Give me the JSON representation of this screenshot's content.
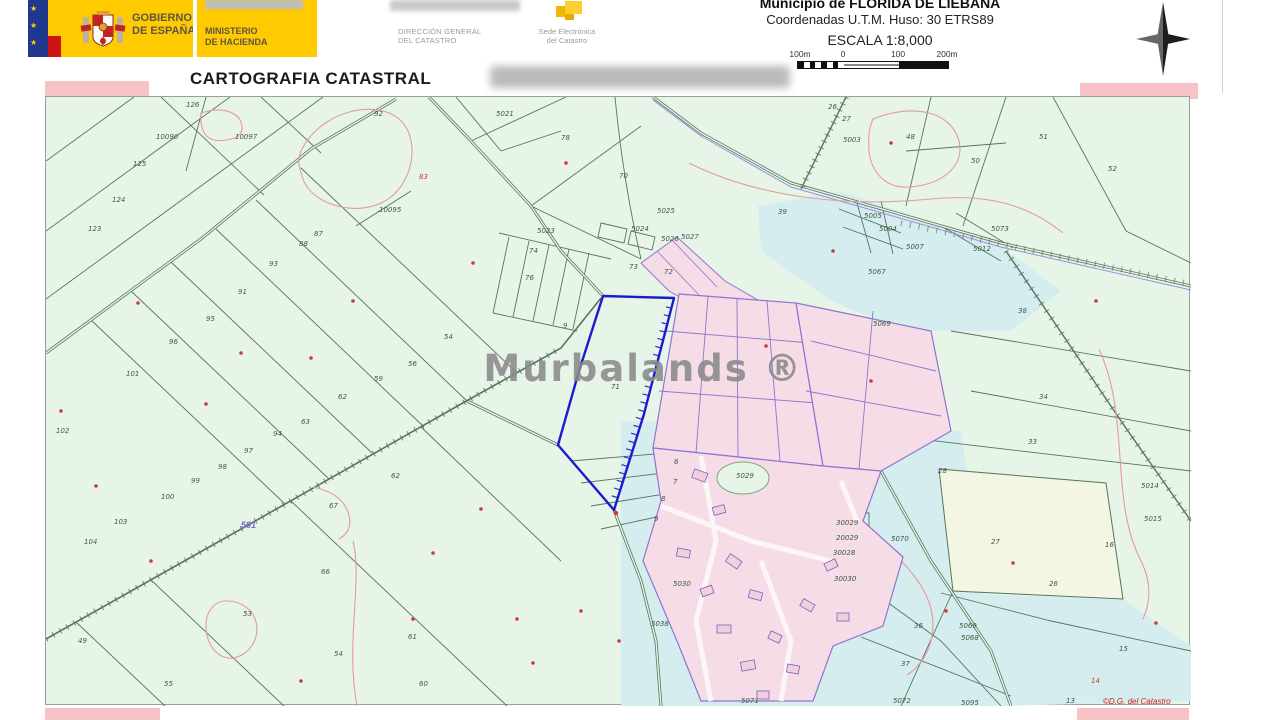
{
  "header": {
    "gobierno": {
      "line1": "GOBIERNO",
      "line2": "DE ESPAÑA"
    },
    "ministerio": {
      "line1": "MINISTERIO",
      "line2": "DE HACIENDA"
    },
    "direccion": {
      "line1": "DIRECCIÓN GENERAL",
      "line2": "DEL CATASTRO"
    },
    "sede": {
      "line1": "Sede Electrónica",
      "line2": "del Catastro"
    },
    "municipio": "Municipio de FLORIDA DE LIEBANA",
    "coordenadas": "Coordenadas U.T.M. Huso: 30 ETRS89",
    "escala": "ESCALA 1:8,000",
    "scalebar": {
      "l0": "100m",
      "l1": "0",
      "l2": "100",
      "l3": "200m"
    },
    "title": "CARTOGRAFIA CATASTRAL"
  },
  "map": {
    "watermark": "Murbalands ®",
    "credit": "©D.G. del Catastro",
    "road_label": "501",
    "highlighted_parcel": "71",
    "colors": {
      "background": "#e7f5e8",
      "cyan_zone": "#d6edef",
      "cream_zone": "#f3f6e2",
      "parcel_line": "#55755e",
      "contour_red": "#e49a9a",
      "village_fill": "#f5dce6",
      "village_stroke": "#8f74d2",
      "highlight_blue": "#1a1ad0"
    },
    "labels": [
      {
        "t": "126",
        "x": 185,
        "y": 106,
        "c": "g"
      },
      {
        "t": "10090",
        "x": 155,
        "y": 138,
        "c": "g"
      },
      {
        "t": "10097",
        "x": 234,
        "y": 138,
        "c": "g"
      },
      {
        "t": "125",
        "x": 132,
        "y": 165,
        "c": "g"
      },
      {
        "t": "124",
        "x": 111,
        "y": 201,
        "c": "g"
      },
      {
        "t": "123",
        "x": 87,
        "y": 230,
        "c": "g"
      },
      {
        "t": "92",
        "x": 373,
        "y": 115,
        "c": "g"
      },
      {
        "t": "88",
        "x": 298,
        "y": 245,
        "c": "g"
      },
      {
        "t": "87",
        "x": 313,
        "y": 235,
        "c": "g"
      },
      {
        "t": "93",
        "x": 268,
        "y": 265,
        "c": "g"
      },
      {
        "t": "91",
        "x": 237,
        "y": 293,
        "c": "g"
      },
      {
        "t": "95",
        "x": 205,
        "y": 320,
        "c": "g"
      },
      {
        "t": "96",
        "x": 168,
        "y": 343,
        "c": "g"
      },
      {
        "t": "101",
        "x": 125,
        "y": 375,
        "c": "g"
      },
      {
        "t": "102",
        "x": 55,
        "y": 432,
        "c": "g"
      },
      {
        "t": "10095",
        "x": 378,
        "y": 211,
        "c": "g"
      },
      {
        "t": "83",
        "x": 418,
        "y": 178,
        "c": "r"
      },
      {
        "t": "100",
        "x": 160,
        "y": 498,
        "c": "g"
      },
      {
        "t": "103",
        "x": 113,
        "y": 523,
        "c": "g"
      },
      {
        "t": "104",
        "x": 83,
        "y": 543,
        "c": "g"
      },
      {
        "t": "99",
        "x": 190,
        "y": 482,
        "c": "g"
      },
      {
        "t": "98",
        "x": 217,
        "y": 468,
        "c": "g"
      },
      {
        "t": "97",
        "x": 243,
        "y": 452,
        "c": "g"
      },
      {
        "t": "94",
        "x": 272,
        "y": 435,
        "c": "g"
      },
      {
        "t": "63",
        "x": 300,
        "y": 423,
        "c": "g"
      },
      {
        "t": "67",
        "x": 328,
        "y": 507,
        "c": "g"
      },
      {
        "t": "62",
        "x": 390,
        "y": 477,
        "c": "g"
      },
      {
        "t": "66",
        "x": 320,
        "y": 573,
        "c": "g"
      },
      {
        "t": "53",
        "x": 242,
        "y": 615,
        "c": "g"
      },
      {
        "t": "49",
        "x": 77,
        "y": 642,
        "c": "g"
      },
      {
        "t": "55",
        "x": 163,
        "y": 685,
        "c": "g"
      },
      {
        "t": "54",
        "x": 333,
        "y": 655,
        "c": "g"
      },
      {
        "t": "61",
        "x": 407,
        "y": 638,
        "c": "g"
      },
      {
        "t": "60",
        "x": 418,
        "y": 685,
        "c": "g"
      },
      {
        "t": "54",
        "x": 443,
        "y": 338,
        "c": "g"
      },
      {
        "t": "56",
        "x": 407,
        "y": 365,
        "c": "g"
      },
      {
        "t": "59",
        "x": 373,
        "y": 380,
        "c": "g"
      },
      {
        "t": "62",
        "x": 337,
        "y": 398,
        "c": "g"
      },
      {
        "t": "70",
        "x": 618,
        "y": 177,
        "c": "g"
      },
      {
        "t": "5021",
        "x": 495,
        "y": 115,
        "c": "g"
      },
      {
        "t": "78",
        "x": 560,
        "y": 139,
        "c": "g"
      },
      {
        "t": "76",
        "x": 524,
        "y": 279,
        "c": "g"
      },
      {
        "t": "74",
        "x": 528,
        "y": 252,
        "c": "g"
      },
      {
        "t": "73",
        "x": 628,
        "y": 268,
        "c": "g"
      },
      {
        "t": "72",
        "x": 663,
        "y": 273,
        "c": "g"
      },
      {
        "t": "5023",
        "x": 536,
        "y": 232,
        "c": "g"
      },
      {
        "t": "5024",
        "x": 630,
        "y": 230,
        "c": "g"
      },
      {
        "t": "5025",
        "x": 656,
        "y": 212,
        "c": "g"
      },
      {
        "t": "5026",
        "x": 660,
        "y": 240,
        "c": "g"
      },
      {
        "t": "5027",
        "x": 680,
        "y": 238,
        "c": "g"
      },
      {
        "t": "9",
        "x": 562,
        "y": 327,
        "c": "g"
      },
      {
        "t": "71",
        "x": 610,
        "y": 388,
        "c": "g"
      },
      {
        "t": "26",
        "x": 827,
        "y": 108,
        "c": "g"
      },
      {
        "t": "27",
        "x": 841,
        "y": 120,
        "c": "g"
      },
      {
        "t": "5003",
        "x": 842,
        "y": 141,
        "c": "g"
      },
      {
        "t": "48",
        "x": 905,
        "y": 138,
        "c": "g"
      },
      {
        "t": "50",
        "x": 970,
        "y": 162,
        "c": "g"
      },
      {
        "t": "51",
        "x": 1038,
        "y": 138,
        "c": "g"
      },
      {
        "t": "52",
        "x": 1107,
        "y": 170,
        "c": "g"
      },
      {
        "t": "39",
        "x": 777,
        "y": 213,
        "c": "g"
      },
      {
        "t": "5004",
        "x": 878,
        "y": 230,
        "c": "g"
      },
      {
        "t": "5005",
        "x": 863,
        "y": 217,
        "c": "g"
      },
      {
        "t": "5007",
        "x": 905,
        "y": 248,
        "c": "g"
      },
      {
        "t": "5067",
        "x": 867,
        "y": 273,
        "c": "g"
      },
      {
        "t": "5012",
        "x": 972,
        "y": 250,
        "c": "g"
      },
      {
        "t": "5073",
        "x": 990,
        "y": 230,
        "c": "g"
      },
      {
        "t": "38",
        "x": 1017,
        "y": 312,
        "c": "g"
      },
      {
        "t": "5069",
        "x": 872,
        "y": 325,
        "c": "g"
      },
      {
        "t": "5029",
        "x": 735,
        "y": 477,
        "c": "g"
      },
      {
        "t": "28",
        "x": 937,
        "y": 472,
        "c": "g"
      },
      {
        "t": "34",
        "x": 1038,
        "y": 398,
        "c": "g"
      },
      {
        "t": "33",
        "x": 1027,
        "y": 443,
        "c": "g"
      },
      {
        "t": "27",
        "x": 990,
        "y": 543,
        "c": "g"
      },
      {
        "t": "26",
        "x": 1048,
        "y": 585,
        "c": "g"
      },
      {
        "t": "5070",
        "x": 890,
        "y": 540,
        "c": "g"
      },
      {
        "t": "30029",
        "x": 835,
        "y": 524,
        "c": "g"
      },
      {
        "t": "20029",
        "x": 835,
        "y": 539,
        "c": "g"
      },
      {
        "t": "30028",
        "x": 832,
        "y": 554,
        "c": "g"
      },
      {
        "t": "30030",
        "x": 833,
        "y": 580,
        "c": "g"
      },
      {
        "t": "5030",
        "x": 672,
        "y": 585,
        "c": "g"
      },
      {
        "t": "5038",
        "x": 650,
        "y": 625,
        "c": "g"
      },
      {
        "t": "36",
        "x": 913,
        "y": 627,
        "c": "g"
      },
      {
        "t": "37",
        "x": 900,
        "y": 665,
        "c": "g"
      },
      {
        "t": "5069",
        "x": 958,
        "y": 627,
        "c": "g"
      },
      {
        "t": "5068",
        "x": 960,
        "y": 639,
        "c": "g"
      },
      {
        "t": "5071",
        "x": 740,
        "y": 702,
        "c": "g"
      },
      {
        "t": "5072",
        "x": 892,
        "y": 702,
        "c": "g"
      },
      {
        "t": "5095",
        "x": 960,
        "y": 704,
        "c": "g"
      },
      {
        "t": "5014",
        "x": 1140,
        "y": 487,
        "c": "g"
      },
      {
        "t": "5015",
        "x": 1143,
        "y": 520,
        "c": "g"
      },
      {
        "t": "16",
        "x": 1104,
        "y": 546,
        "c": "g"
      },
      {
        "t": "15",
        "x": 1118,
        "y": 650,
        "c": "g"
      },
      {
        "t": "13",
        "x": 1065,
        "y": 702,
        "c": "g"
      },
      {
        "t": "14",
        "x": 1090,
        "y": 682,
        "c": "r"
      },
      {
        "t": "6",
        "x": 673,
        "y": 463,
        "c": "g"
      },
      {
        "t": "7",
        "x": 672,
        "y": 483,
        "c": "g"
      },
      {
        "t": "8",
        "x": 660,
        "y": 500,
        "c": "g"
      },
      {
        "t": "9",
        "x": 653,
        "y": 520,
        "c": "g"
      }
    ]
  }
}
